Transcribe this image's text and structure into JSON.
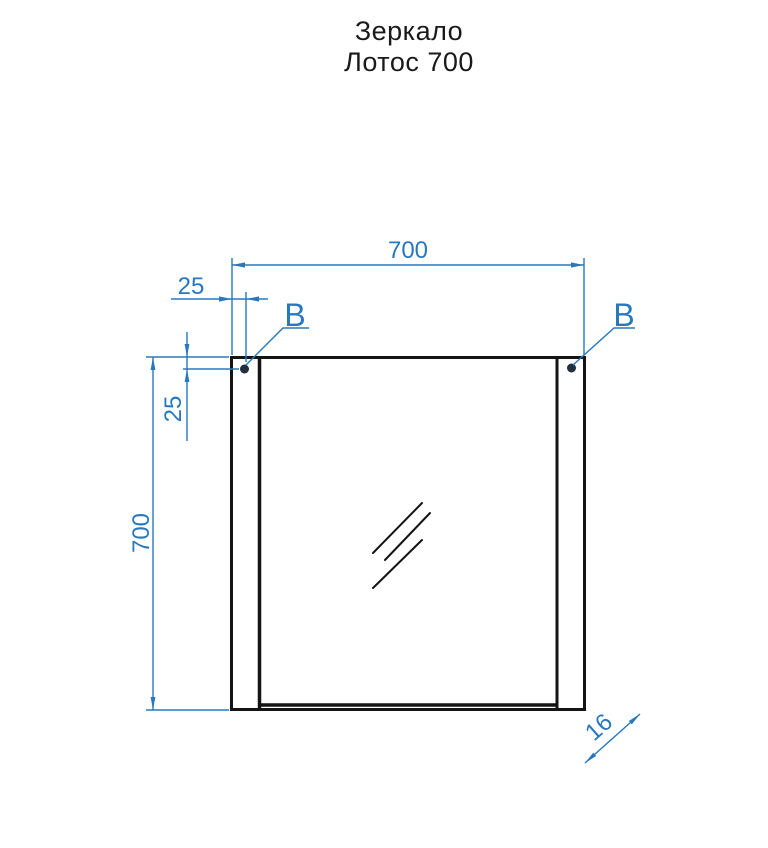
{
  "title": {
    "line1": "Зеркало",
    "line2": "Лотос 700"
  },
  "dimensions": {
    "overall_width": "700",
    "overall_height": "700",
    "mount_offset_horizontal": "25",
    "mount_offset_vertical": "25",
    "panel_thickness": "16"
  },
  "labels": {
    "mount_point_left": "B",
    "mount_point_right": "B"
  },
  "colors": {
    "dimension": "#2878be",
    "outline": "#141414",
    "dot": "#22303c",
    "title_text": "#1a1a1a",
    "background": "#ffffff"
  }
}
